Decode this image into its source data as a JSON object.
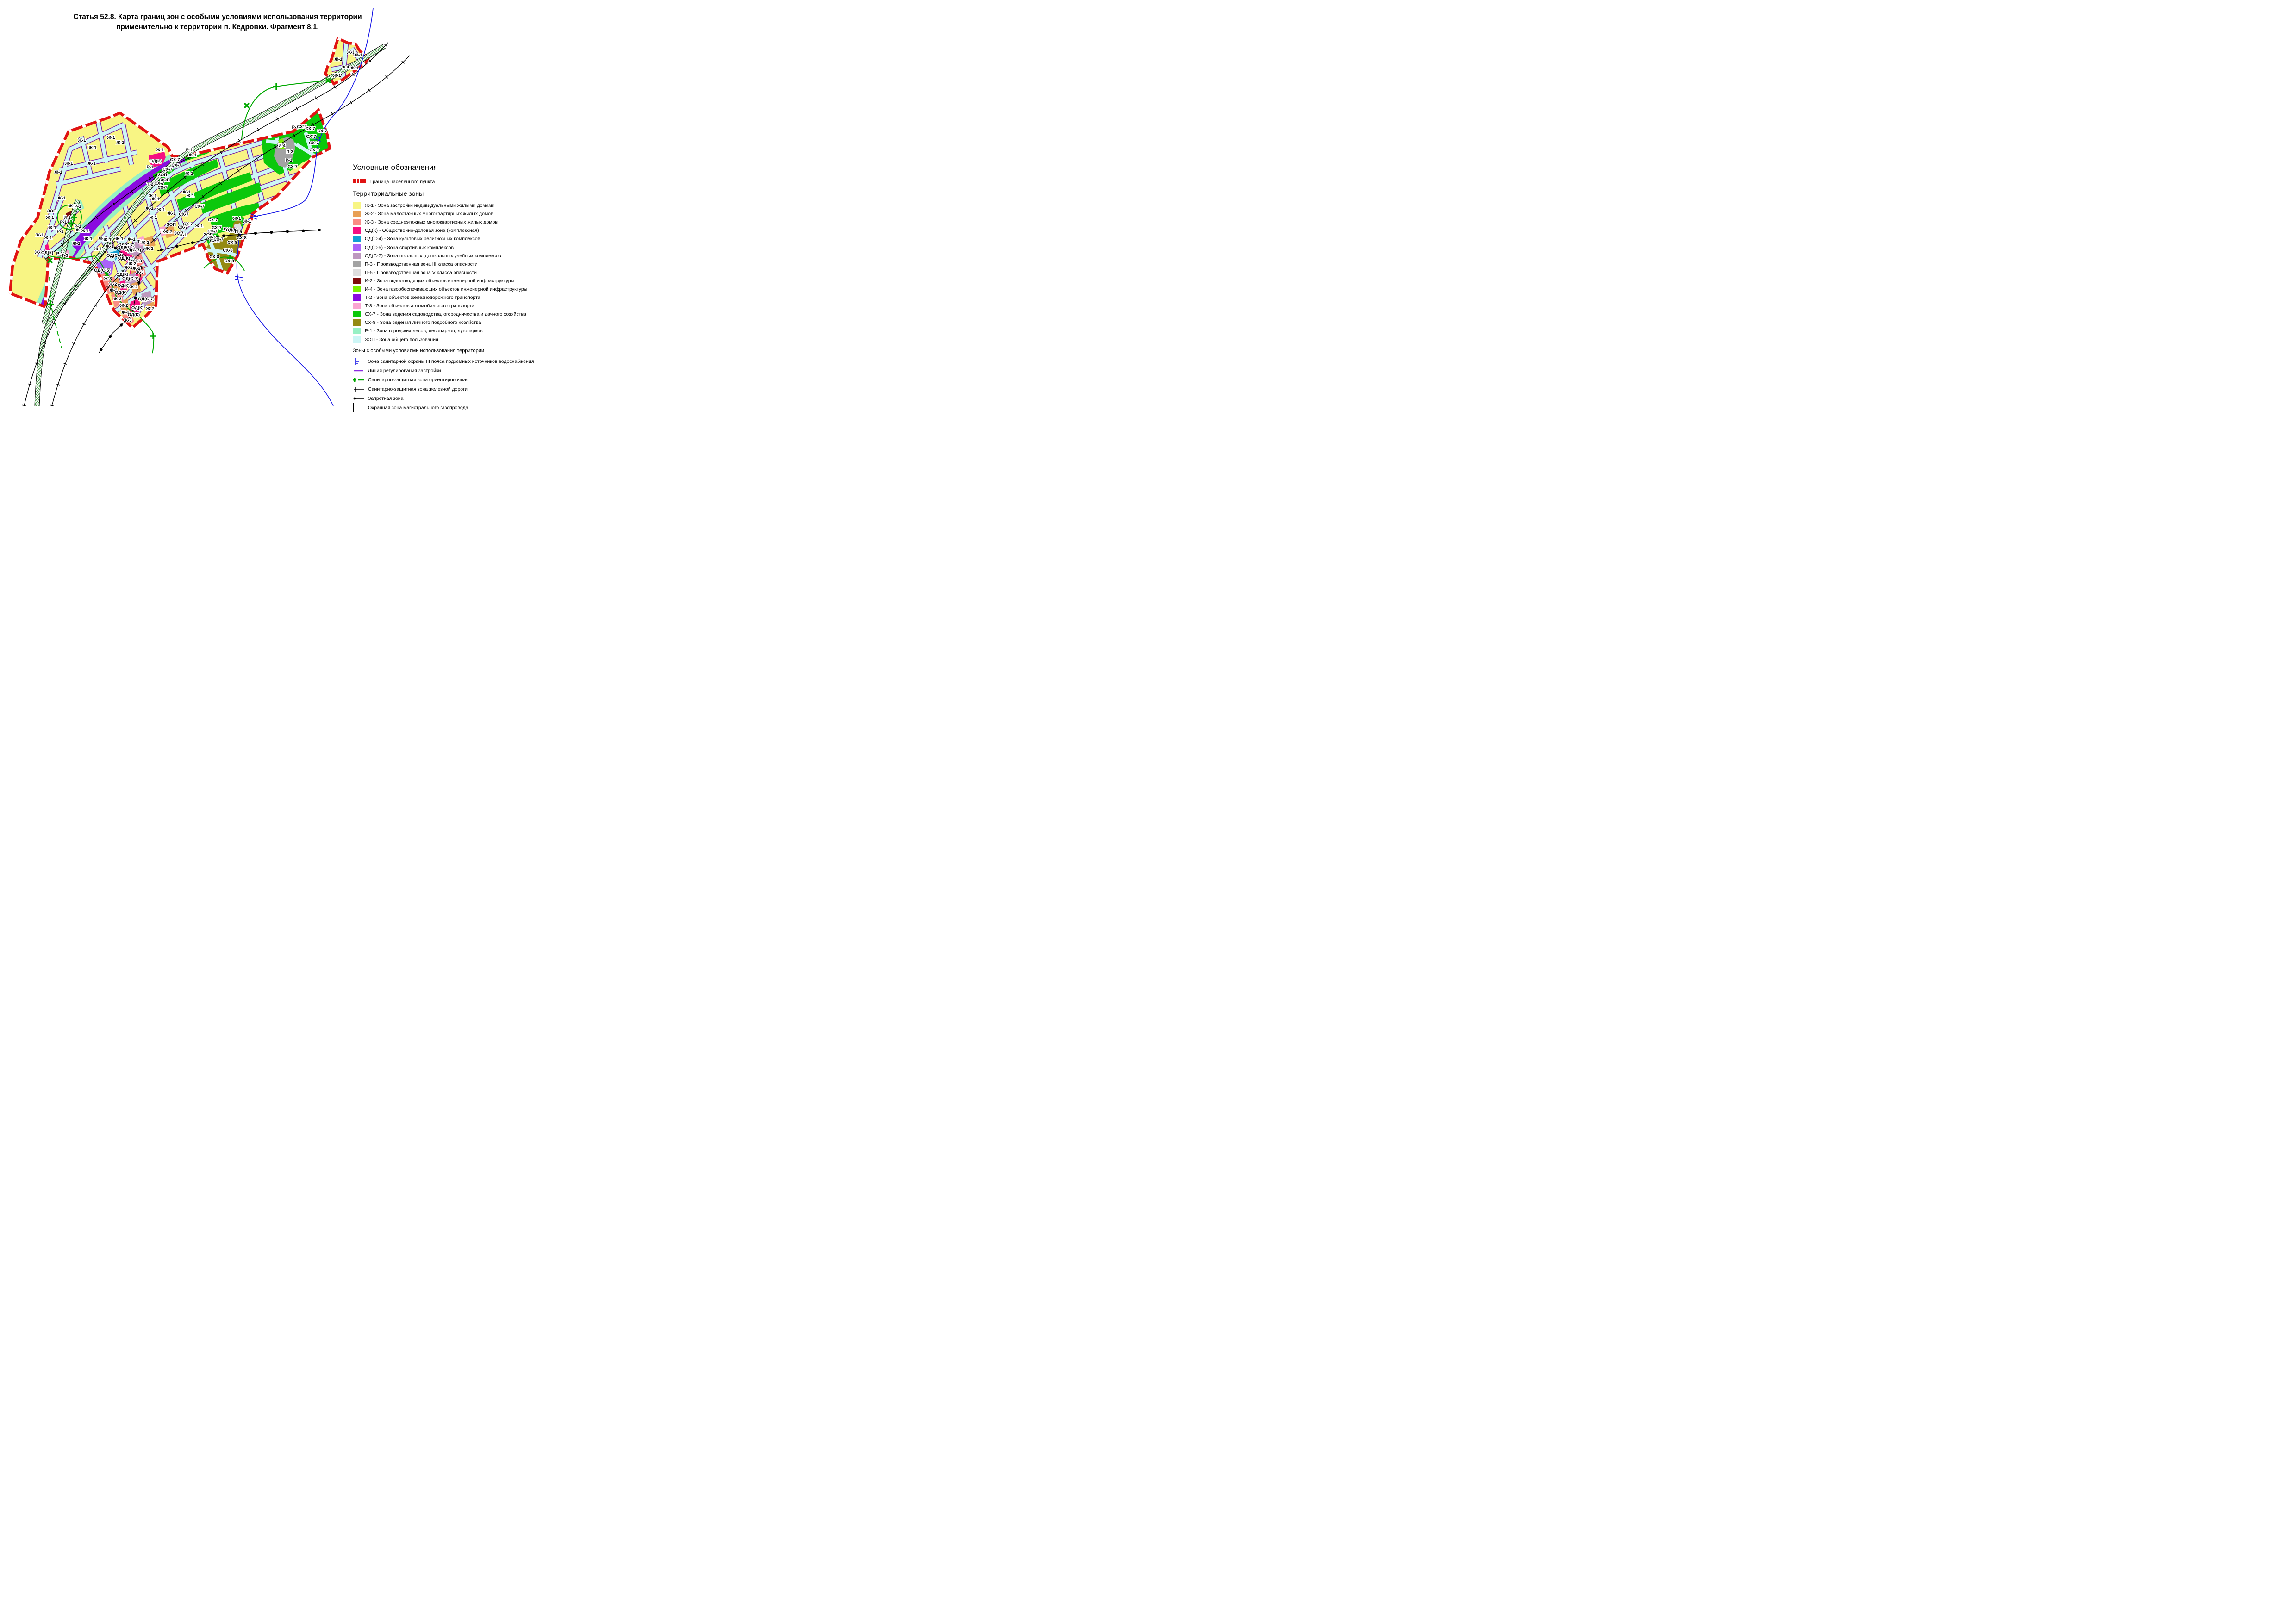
{
  "title": {
    "line1": "Статья 52.8. Карта границ зон с особыми условиями использования территории",
    "line2": "применительно к территории п. Кедровки. Фрагмент 8.1."
  },
  "legend": {
    "header": "Условные обозначения",
    "boundary_label": "Граница населенного пункта",
    "zones_header": "Территориальные зоны",
    "zones": [
      {
        "key": "zh1",
        "code": "Ж-1",
        "color": "#F8F584",
        "label": "Ж-1 - Зона застройки индивидуальными жилыми домами"
      },
      {
        "key": "zh2",
        "code": "Ж-2",
        "color": "#E8A055",
        "label": "Ж-2 - Зона малоэтажных многоквартирных жилых домов"
      },
      {
        "key": "zh3",
        "code": "Ж-3",
        "color": "#FA8C84",
        "label": "Ж-3 - Зона среднеэтажных многоквартирных жилых домов"
      },
      {
        "key": "odk",
        "code": "ОД(К)",
        "color": "#F50F82",
        "label": "ОД(К) - Общественно-деловая зона (комплексная)"
      },
      {
        "key": "ods4",
        "code": "ОД(С-4)",
        "color": "#129FD4",
        "label": "ОД(С-4) - Зона культовых религиозных комплексов"
      },
      {
        "key": "ods5",
        "code": "ОД(С-5)",
        "color": "#AA62F8",
        "label": "ОД(С-5) - Зона спортивных комплексов"
      },
      {
        "key": "ods7",
        "code": "ОД(С-7)",
        "color": "#BD98BF",
        "label": "ОД(С-7) - Зона школьных, дошкольных учебных комплексов"
      },
      {
        "key": "p3",
        "code": "П-3",
        "color": "#A3A3A3",
        "label": "П-3 - Производственная зона III класса опасности"
      },
      {
        "key": "p5",
        "code": "П-5",
        "color": "#DEDEDE",
        "label": "П-5 - Производственная зона V класса опасности"
      },
      {
        "key": "i2",
        "code": "И-2",
        "color": "#7F0B0B",
        "label": "И-2 - Зона водоотводящих объектов инженерной инфраструктуры"
      },
      {
        "key": "i4",
        "code": "И-4",
        "color": "#7CEF00",
        "label": "И-4 - Зона газообеспечивающих объектов инженерной инфраструктуры"
      },
      {
        "key": "t2",
        "code": "Т-2",
        "color": "#8A0BE0",
        "label": "Т-2 - Зона объектов железнодорожного транспорта"
      },
      {
        "key": "t3",
        "code": "Т-3",
        "color": "#FAA5D2",
        "label": "Т-3 - Зона объектов автомобильного транспорта"
      },
      {
        "key": "sx7",
        "code": "СХ-7",
        "color": "#0BC80B",
        "label": "СХ-7 - Зона ведения садоводства, огородничества и дачного хозяйства"
      },
      {
        "key": "sx8",
        "code": "СХ-8",
        "color": "#948A12",
        "label": "СХ-8 - Зона ведения личного подсобного хозяйства"
      },
      {
        "key": "r1",
        "code": "Р-1",
        "color": "#97F0C4",
        "label": "Р-1 - Зона городских лесов, лесопарков, лугопарков"
      },
      {
        "key": "zop",
        "code": "ЗОП",
        "color": "#CDF6F6",
        "label": "ЗОП - Зона общего пользования"
      }
    ],
    "special_header": "Зоны с особыми условиями использования территории",
    "special": [
      {
        "symbol": "water-protection-line",
        "label": "Зона санитарной охраны III пояса подземных источников водоснабжения"
      },
      {
        "symbol": "regulation-line",
        "label": "Линия регулирования застройки"
      },
      {
        "symbol": "sanitary-approx-line",
        "label": "Санитарно-защитная зона ориентировочная"
      },
      {
        "symbol": "railway-sanitary-line",
        "label": "Санитарно-защитная зона железной дороги"
      },
      {
        "symbol": "forbidden-zone-line",
        "label": "Запретная зона"
      },
      {
        "symbol": "pipeline-protection-area",
        "label": "Охранная зона магистрального газопровода"
      }
    ]
  },
  "map": {
    "palette": {
      "border_red": "#E01313",
      "street_cyan": "#CDF6F6",
      "reg_purple": "#7B1FA2",
      "hatch_green": "#2E8B2E",
      "rail_black": "#000000",
      "water_blue": "#1414E6",
      "sanitary_green": "#00A800",
      "forbidden_black": "#000000"
    },
    "labels": [
      [
        "Ж-1",
        758,
        113
      ],
      [
        "Ж-1",
        774,
        119
      ],
      [
        "Ж-1",
        731,
        128
      ],
      [
        "ЗОП",
        748,
        145
      ],
      [
        "Ж-1",
        766,
        147
      ],
      [
        "Ж-1",
        728,
        163
      ],
      [
        "Ж-1",
        177,
        303
      ],
      [
        "Ж-1",
        240,
        297
      ],
      [
        "Ж-1",
        200,
        319
      ],
      [
        "Ж-1",
        260,
        308
      ],
      [
        "Ж-1",
        149,
        353
      ],
      [
        "Ж-1",
        198,
        353
      ],
      [
        "Ж-1",
        126,
        372
      ],
      [
        "Ж-1",
        133,
        428
      ],
      [
        "ЗОП",
        112,
        456
      ],
      [
        "Ж-1",
        108,
        470
      ],
      [
        "Ж-1",
        157,
        445
      ],
      [
        "Р-1",
        168,
        446
      ],
      [
        "И-2",
        145,
        470
      ],
      [
        "Р-1",
        137,
        480
      ],
      [
        "Ж-1",
        113,
        492
      ],
      [
        "Р-1",
        130,
        500
      ],
      [
        "Ж-1",
        104,
        514
      ],
      [
        "Р-1",
        168,
        489
      ],
      [
        "Ж-1",
        172,
        497
      ],
      [
        "Ж-1",
        184,
        499
      ],
      [
        "Ж-1",
        191,
        516
      ],
      [
        "Ж-1",
        165,
        526
      ],
      [
        "Ж-1",
        86,
        508
      ],
      [
        "Ж-1",
        84,
        545
      ],
      [
        "ОД(К)",
        102,
        546
      ],
      [
        "Р-1",
        129,
        548
      ],
      [
        "Т-3",
        140,
        552
      ],
      [
        "Ж-1",
        346,
        324
      ],
      [
        "ОД(К)",
        336,
        348
      ],
      [
        "Р-1",
        324,
        361
      ],
      [
        "Р-1",
        409,
        324
      ],
      [
        "Ж-1",
        416,
        335
      ],
      [
        "СХ-7",
        378,
        345
      ],
      [
        "СХ-7",
        381,
        357
      ],
      [
        "СХ-7",
        362,
        366
      ],
      [
        "ЗОП",
        351,
        378
      ],
      [
        "Т-2",
        324,
        398
      ],
      [
        "СХ-7",
        344,
        396
      ],
      [
        "Ж-1",
        409,
        375
      ],
      [
        "Ж-1",
        403,
        415
      ],
      [
        "Ж-1",
        330,
        423
      ],
      [
        "СХ-7",
        351,
        405
      ],
      [
        "ЗОП",
        357,
        389
      ],
      [
        "Ж-1",
        336,
        430
      ],
      [
        "Ж-1",
        323,
        450
      ],
      [
        "Ж-1",
        348,
        453
      ],
      [
        "Ж-1",
        331,
        470
      ],
      [
        "Ж-1",
        371,
        461
      ],
      [
        "Ж-1",
        411,
        423
      ],
      [
        "СХ-7",
        397,
        463
      ],
      [
        "СХ-7",
        431,
        446
      ],
      [
        "СХ-7",
        406,
        484
      ],
      [
        "СХ-7",
        395,
        491
      ],
      [
        "Ж-1",
        430,
        488
      ],
      [
        "ЗОП",
        370,
        485
      ],
      [
        "ЗОП",
        386,
        504
      ],
      [
        "Ж-1",
        395,
        508
      ],
      [
        "Т-3",
        354,
        500
      ],
      [
        "Ж-2",
        363,
        501
      ],
      [
        "Р-1",
        638,
        275
      ],
      [
        "СХ-7",
        652,
        274
      ],
      [
        "СХ-7",
        670,
        278
      ],
      [
        "СХ-7",
        696,
        283
      ],
      [
        "СХ-7",
        672,
        295
      ],
      [
        "СХ-7",
        678,
        309
      ],
      [
        "СХ-7",
        679,
        324
      ],
      [
        "И-4",
        609,
        315
      ],
      [
        "П-3",
        626,
        328
      ],
      [
        "Р-1",
        624,
        346
      ],
      [
        "СХ-7",
        632,
        360
      ],
      [
        "Ж-1",
        512,
        472
      ],
      [
        "Ж-1",
        534,
        478
      ],
      [
        "СХ-7",
        460,
        475
      ],
      [
        "СХ-7",
        468,
        492
      ],
      [
        "СХ-7",
        459,
        500
      ],
      [
        "Ж-1",
        491,
        495
      ],
      [
        "ОД(К)",
        501,
        497
      ],
      [
        "П-5",
        515,
        501
      ],
      [
        "ЗОП",
        450,
        507
      ],
      [
        "Ж-1",
        458,
        513
      ],
      [
        "СХ-8",
        522,
        514
      ],
      [
        "СХ-8",
        464,
        520
      ],
      [
        "СХ-7",
        472,
        517
      ],
      [
        "СХ-8",
        502,
        524
      ],
      [
        "СХ-8",
        492,
        541
      ],
      [
        "СХ-8",
        463,
        555
      ],
      [
        "СХ-8",
        495,
        564
      ],
      [
        "Ж-1",
        221,
        515
      ],
      [
        "Ж-1",
        232,
        518
      ],
      [
        "Ж-1",
        258,
        516
      ],
      [
        "Ж-1",
        284,
        517
      ],
      [
        "Т-3",
        304,
        522
      ],
      [
        "Ж-2",
        314,
        524
      ],
      [
        "ОД(С-7)",
        273,
        529
      ],
      [
        "ОД(К)",
        266,
        535
      ],
      [
        "ОД(С-7)",
        287,
        540
      ],
      [
        "Ж-2",
        323,
        537
      ],
      [
        "Ж-1",
        237,
        532
      ],
      [
        "Ж-1",
        212,
        538
      ],
      [
        "ОД(С-4)",
        248,
        552
      ],
      [
        "ОД(К)",
        268,
        558
      ],
      [
        "Ж-3",
        298,
        564
      ],
      [
        "Ж-2",
        286,
        570
      ],
      [
        "ОД(С-5)",
        221,
        584
      ],
      [
        "Ж-2",
        278,
        578
      ],
      [
        "Ж-2",
        295,
        580
      ],
      [
        "Ж-3",
        302,
        588
      ],
      [
        "ОД(К)",
        264,
        593
      ],
      [
        "Ж-3",
        233,
        602
      ],
      [
        "ОД(С-7)",
        282,
        602
      ],
      [
        "Ж-2",
        244,
        614
      ],
      [
        "ОД(К)",
        267,
        617
      ],
      [
        "Ж-2",
        289,
        620
      ],
      [
        "Ж-2",
        245,
        627
      ],
      [
        "ОД(К)",
        261,
        632
      ],
      [
        "Ж-3",
        254,
        646
      ],
      [
        "Ж-2",
        268,
        660
      ],
      [
        "Ж-2",
        271,
        675
      ],
      [
        "ОД(К)",
        297,
        665
      ],
      [
        "ОД(К)",
        289,
        680
      ],
      [
        "ОД(С-7)",
        316,
        646
      ],
      [
        "Ж-2",
        324,
        667
      ],
      [
        "Ж-3",
        276,
        692
      ]
    ]
  }
}
